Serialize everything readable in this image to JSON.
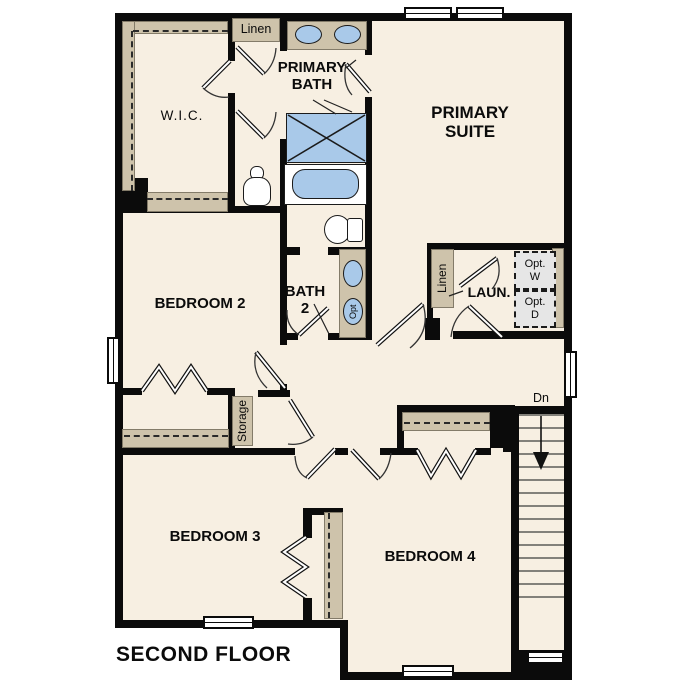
{
  "title": "SECOND FLOOR",
  "colors": {
    "floor": "#f7efe2",
    "wall": "#0b0b0b",
    "counter": "#cec3ab",
    "fixture_blue": "#a9c9e9",
    "optional_box": "#e6e6e6"
  },
  "rooms": {
    "primary_suite": {
      "line1": "PRIMARY",
      "line2": "SUITE"
    },
    "primary_bath": {
      "line1": "PRIMARY",
      "line2": "BATH"
    },
    "wic": {
      "label": "W.I.C."
    },
    "bedroom2": {
      "label": "BEDROOM 2"
    },
    "bath2": {
      "line1": "BATH",
      "line2": "2"
    },
    "laundry": {
      "label": "LAUN."
    },
    "bedroom3": {
      "label": "BEDROOM 3"
    },
    "bedroom4": {
      "label": "BEDROOM 4"
    }
  },
  "closets": {
    "linen_upper": "Linen",
    "linen_laundry": "Linen",
    "storage": "Storage"
  },
  "optional": {
    "washer": {
      "line1": "Opt.",
      "line2": "W"
    },
    "dryer": {
      "line1": "Opt.",
      "line2": "D"
    },
    "sink": "Opt"
  },
  "stairs": {
    "down": "Dn"
  }
}
